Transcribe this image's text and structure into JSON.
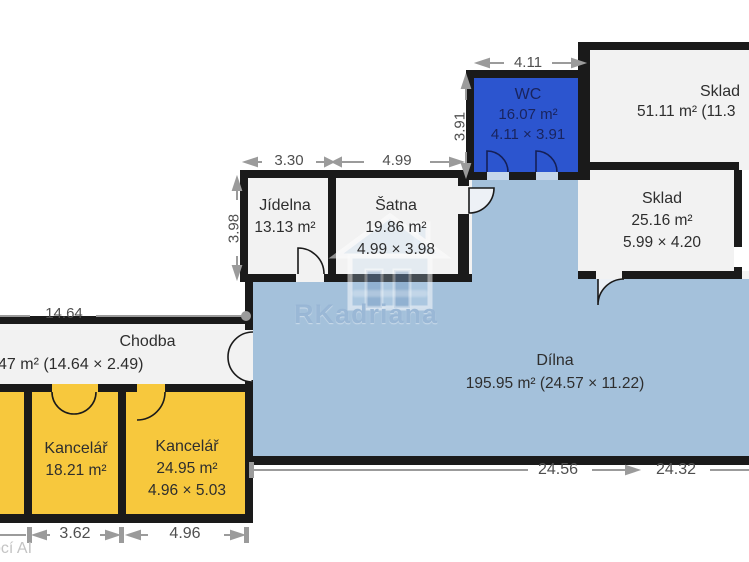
{
  "rooms": {
    "wc": {
      "name": "WC",
      "area": "16.07 m²",
      "size": "4.11 × 3.91"
    },
    "sklad_top": {
      "name": "Sklad",
      "area": "51.11 m² (11.3"
    },
    "sklad": {
      "name": "Sklad",
      "area": "25.16 m²",
      "size": "5.99 × 4.20"
    },
    "jidelna": {
      "name": "Jídelna",
      "area": "13.13 m²"
    },
    "satna": {
      "name": "Šatna",
      "area": "19.86 m²",
      "size": "4.99 × 3.98"
    },
    "dilna": {
      "name": "Dílna",
      "area": "195.95 m² (24.57 × 11.22)"
    },
    "chodba": {
      "name": "Chodba",
      "area": "47 m² (14.64 × 2.49)"
    },
    "kancelar_1": {
      "name": "Kancelář",
      "area": "18.21 m²"
    },
    "kancelar_2": {
      "name": "Kancelář",
      "area": "24.95 m²",
      "size": "4.96 × 5.03"
    }
  },
  "dimensions": {
    "wc_width": "4.11",
    "wc_height": "3.91",
    "jidelna_width": "3.30",
    "satna_width": "4.99",
    "block_height": "3.98",
    "chodba_width": "14.64",
    "kancelar_1_width": "3.62",
    "kancelar_2_width": "4.96",
    "dilna_width_a": "24.56",
    "dilna_width_b": "24.32"
  },
  "watermark": {
    "brand": "RKadriana",
    "corner_note": "ocí AI"
  },
  "colors": {
    "wc_room": "#2c55cf",
    "workshop_room": "#a4c1db",
    "office_room": "#f7c83d",
    "storage_room": "#f2f2f2",
    "wall": "#1a1a1a",
    "dimension": "#9b9b9b"
  }
}
